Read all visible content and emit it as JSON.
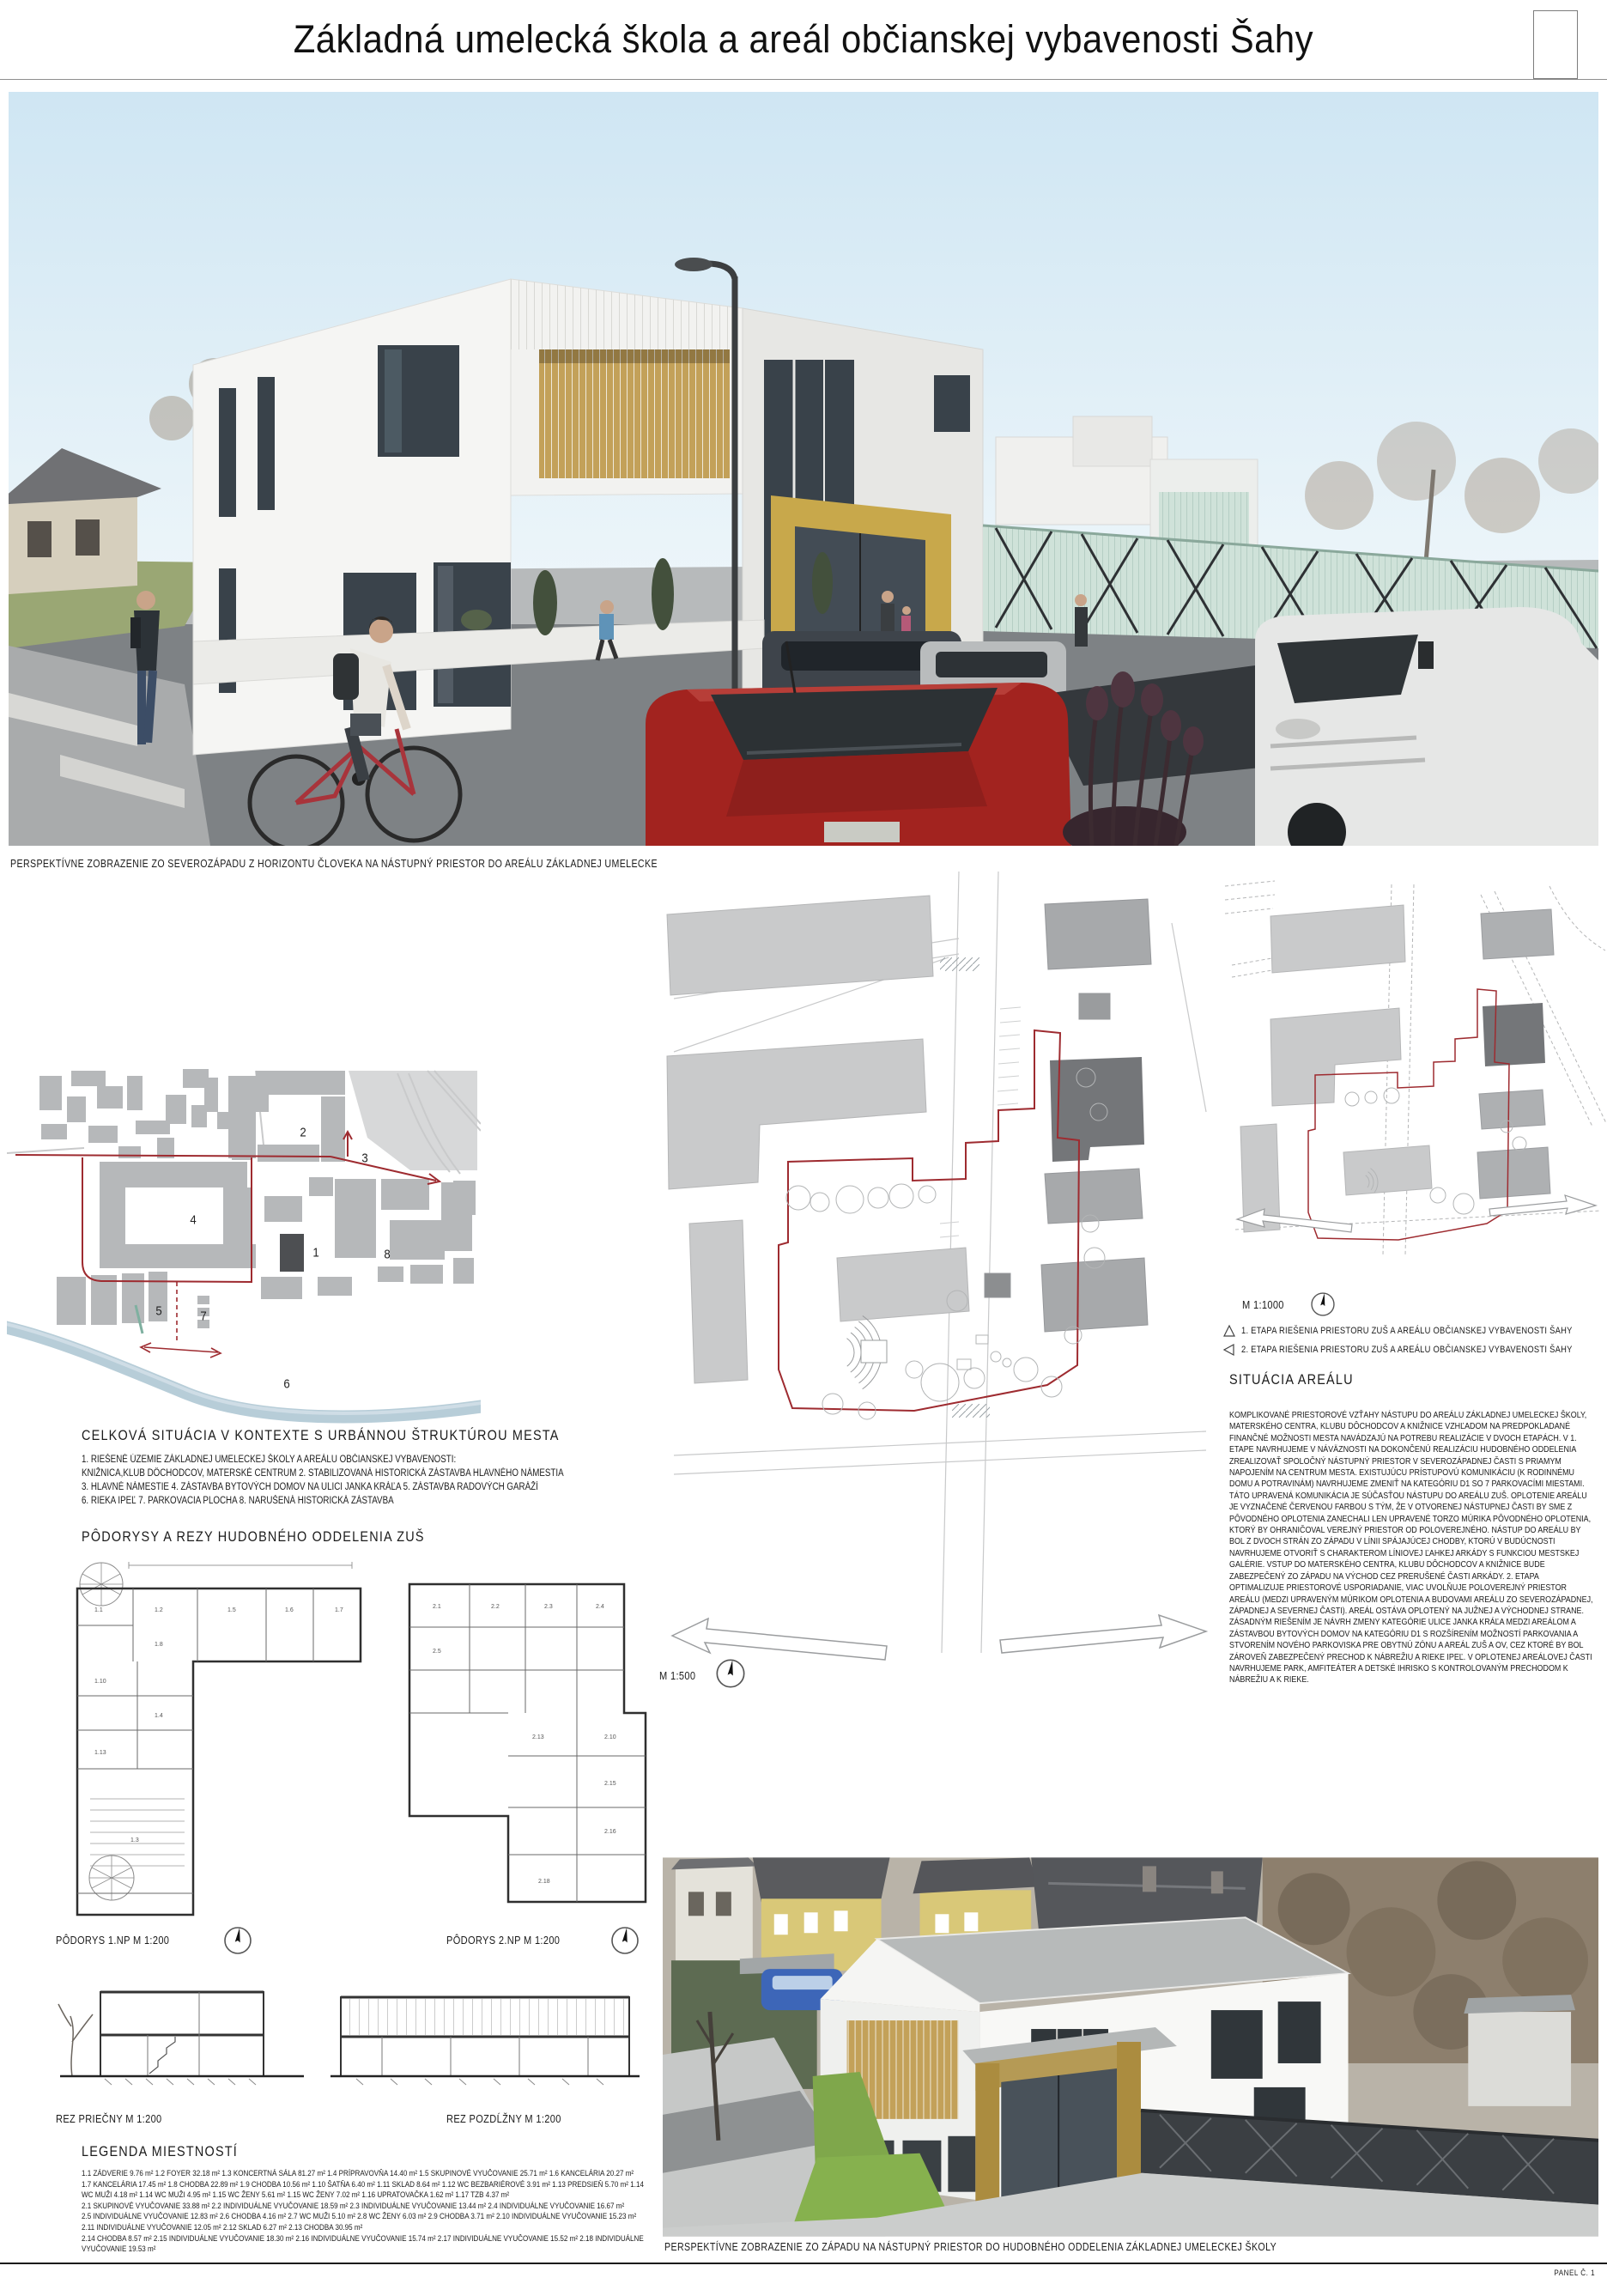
{
  "title": "Základná umelecká škola a areál občianskej vybavenosti Šahy",
  "main_photo": {
    "caption": "PERSPEKTÍVNE ZOBRAZENIE ZO SEVEROZÁPADU Z HORIZONTU ČLOVEKA NA NÁSTUPNÝ PRIESTOR DO AREÁLU ZÁKLADNEJ UMELECKEJ ŠKOLY"
  },
  "context_map": {
    "heading": "CELKOVÁ SITUÁCIA V KONTEXTE S URBÁNNOU ŠTRUKTÚROU MESTA",
    "legend_lines": [
      "1. RIEŠENÉ ÚZEMIE ZÁKLADNEJ UMELECKEJ ŠKOLY A AREÁLU OBČIANSKEJ VYBAVENOSTI:",
      "KNIŽNICA,KLUB DÔCHODCOV, MATERSKÉ CENTRUM 2. STABILIZOVANÁ HISTORICKÁ ZÁSTAVBA HLAVNÉHO NÁMESTIA",
      "3. HLAVNÉ NÁMESTIE 4. ZÁSTAVBA BYTOVÝCH DOMOV NA ULICI JANKA KRÁĽA 5. ZÁSTAVBA RADOVÝCH GARÁŽÍ",
      "6. RIEKA IPEĽ 7. PARKOVACIA PLOCHA 8. NARUŠENÁ HISTORICKÁ ZÁSTAVBA"
    ],
    "markers": [
      "2",
      "3",
      "4",
      "1",
      "8",
      "5",
      "7",
      "6"
    ]
  },
  "plans": {
    "heading": "PÔDORYSY  A REZY HUDOBNÉHO ODDELENIA ZUŠ",
    "plan1_label": "PÔDORYS 1.NP M 1:200",
    "plan2_label": "PÔDORYS 2.NP M 1:200",
    "section1_label": "REZ PRIEČNY M 1:200",
    "section2_label": "REZ POZDĹŽNY M 1:200",
    "p1_rooms": [
      "1.1",
      "1.2",
      "1.5",
      "1.6",
      "1.7",
      "1.8",
      "1.10",
      "1.4",
      "1.13",
      "1.3"
    ],
    "p2_rooms": [
      "2.1",
      "2.2",
      "2.3",
      "2.4",
      "2.5",
      "2.13",
      "2.10",
      "2.15",
      "2.16",
      "2.18"
    ]
  },
  "room_legend": {
    "heading": "LEGENDA MIESTNOSTÍ",
    "lines": [
      "1.1 ZÁDVERIE 9.76 m² 1.2 FOYER 32.18 m² 1.3 KONCERTNÁ SÁLA 81.27 m² 1.4 PRÍPRAVOVŇA 14.40 m² 1.5 SKUPINOVÉ VYUČOVANIE 25.71 m² 1.6 KANCELÁRIA 20.27 m²",
      "1.7 KANCELÁRIA 17.45 m² 1.8 CHODBA 22.89 m² 1.9 CHODBA 10.56 m² 1.10 ŠATŇA 6.40 m² 1.11 SKLAD 8.64 m² 1.12 WC BEZBARIÉROVÉ 3.91 m² 1.13 PREDSIEŇ 5.70 m² 1.14",
      "WC MUŽI 4.18 m² 1.14 WC MUŽI 4.95 m² 1.15 WC ŽENY 5.61 m² 1.15 WC ŽENY 7.02 m² 1.16 UPRATOVAČKA 1.62 m² 1.17 TZB 4.37 m²",
      "2.1 SKUPINOVÉ VYUČOVANIE 33.88 m² 2.2 INDIVIDUÁLNE VYUČOVANIE 18.59 m² 2.3 INDIVIDUÁLNE VYUČOVANIE 13.44 m² 2.4 INDIVIDUÁLNE VYUČOVANIE 16.67 m²",
      "2.5 INDIVIDUÁLNE VYUČOVANIE 12.83 m² 2.6 CHODBA 4.16 m² 2.7 WC MUŽI 5.10 m² 2.8 WC ŽENY 6.03 m² 2.9 CHODBA 3.71 m² 2.10 INDIVIDUÁLNE VYUČOVANIE 15.23 m²",
      "2.11 INDIVIDUÁLNE VYUČOVANIE 12.05 m² 2.12 SKLAD 6.27 m² 2.13 CHODBA 30.95 m²",
      "2.14 CHODBA 8.57 m² 2.15 INDIVIDUÁLNE VYUČOVANIE 18.30 m² 2.16 INDIVIDUÁLNE VYUČOVANIE 15.74 m² 2.17 INDIVIDUÁLNE VYUČOVANIE 15.52 m² 2.18 INDIVIDUÁLNE",
      "VYUČOVANIE 19.53 m²"
    ]
  },
  "site_plan": {
    "scale_label": "M 1:500"
  },
  "area_plan": {
    "scale_label": "M 1:1000",
    "etapa1": "1. ETAPA RIEŠENIA PRIESTORU ZUŠ  A AREÁLU OBČIANSKEJ VYBAVENOSTI ŠAHY",
    "etapa2": "2. ETAPA RIEŠENIA PRIESTORU ZUŠ  A AREÁLU OBČIANSKEJ VYBAVENOSTI ŠAHY",
    "heading": "SITUÁCIA AREÁLU",
    "body": "KOMPLIKOVANÉ PRIESTOROVÉ VZŤAHY NÁSTUPU DO AREÁLU ZÁKLADNEJ UMELECKEJ ŠKOLY, MATERSKÉHO CENTRA, KLUBU DÔCHODCOV A KNIŽNICE VZHĽADOM NA PREDPOKLADANÉ FINANČNÉ MOŽNOSTI MESTA NAVÁDZAJÚ NA POTREBU REALIZÁCIE V DVOCH ETAPÁCH. V 1. ETAPE NAVRHUJEME V NÁVÄZNOSTI NA DOKONČENÚ REALIZÁCIU HUDOBNÉHO ODDELENIA ZREALIZOVAŤ SPOLOČNÝ NÁSTUPNÝ PRIESTOR V SEVEROZÁPADNEJ ČASTI S PRIAMYM NAPOJENÍM NA CENTRUM MESTA. EXISTUJÚCU PRÍSTUPOVÚ KOMUNIKÁCIU (K RODINNÉMU DOMU A POTRAVINÁM) NAVRHUJEME ZMENIŤ NA KATEGÓRIU D1 SO 7 PARKOVACÍMI MIESTAMI. TÁTO UPRAVENÁ KOMUNIKÁCIA JE  SÚČASŤOU NÁSTUPU DO AREÁLU ZUŠ. OPLOTENIE AREÁLU JE VYZNAČENÉ ČERVENOU FARBOU S TÝM, ŽE V OTVORENEJ NÁSTUPNEJ ČASTI BY SME Z PÔVODNÉHO OPLOTENIA ZANECHALI LEN UPRAVENÉ TORZO MÚRIKA PÔVODNÉHO OPLOTENIA, KTORÝ BY OHRANIČOVAL VEREJNÝ PRIESTOR OD POLOVEREJNÉHO. NÁSTUP DO AREÁLU BY BOL Z DVOCH STRÁN ZO ZÁPADU V LÍNII SPÁJAJÚCEJ CHODBY, KTORÚ V BUDÚCNOSTI NAVRHUJEME OTVORIŤ  S CHARAKTEROM LÍNIOVEJ ĽAHKEJ ARKÁDY S FUNKCIOU MESTSKEJ GALÉRIE. VSTUP DO MATERSKÉHO CENTRA, KLUBU DÔCHODCOV A KNIŽNICE BUDE ZABEZPEČENÝ ZO ZÁPADU NA VÝCHOD CEZ PRERUŠENÉ ČASTI ARKÁDY. 2. ETAPA OPTIMALIZUJE PRIESTOROVÉ USPORIADANIE, VIAC UVOLŇUJE POLOVEREJNÝ PRIESTOR  AREÁLU (MEDZI UPRAVENÝM MÚRIKOM OPLOTENIA A BUDOVAMI AREÁLU ZO SEVEROZÁPADNEJ, ZÁPADNEJ A SEVERNEJ ČASTI). AREÁL OSTÁVA OPLOTENÝ NA JUŽNEJ A VÝCHODNEJ STRANE. ZÁSADNÝM RIEŠENÍM JE NÁVRH ZMENY KATEGÓRIE ULICE JANKA KRÁĽA MEDZI AREÁLOM A ZÁSTAVBOU BYTOVÝCH DOMOV NA KATEGÓRIU D1 S ROZŠÍRENÍM MOŽNOSTÍ PARKOVANIA A STVORENÍM NOVÉHO PARKOVISKA PRE OBYTNÚ ZÓNU A AREÁL ZUŠ A OV, CEZ KTORÉ BY BOL ZÁROVEŇ ZABEZPEČENÝ PRECHOD K NÁBREŽIU A RIEKE IPEĽ. V OPLOTENEJ AREÁLOVEJ ČASTI NAVRHUJEME PARK, AMFITEÁTER A DETSKÉ IHRISKO S KONTROLOVANÝM PRECHODOM K NÁBREŽIU A K RIEKE."
  },
  "west_photo": {
    "caption": "PERSPEKTÍVNE ZOBRAZENIE ZO ZÁPADU NA NÁSTUPNÝ PRIESTOR DO HUDOBNÉHO ODDELENIA ZÁKLADNEJ UMELECKEJ ŠKOLY"
  },
  "footer": {
    "panel_label": "PANEL Č. 1"
  },
  "colors": {
    "boundary_red": "#9e2b30",
    "building_gray": "#b6b8ba",
    "dark_building": "#4d4f52",
    "river_blue": "#b7cdd8",
    "wood_gold": "#c8a84b",
    "teal_slats": "#cfe2d9",
    "sky_blue": "#cfe6f3"
  }
}
